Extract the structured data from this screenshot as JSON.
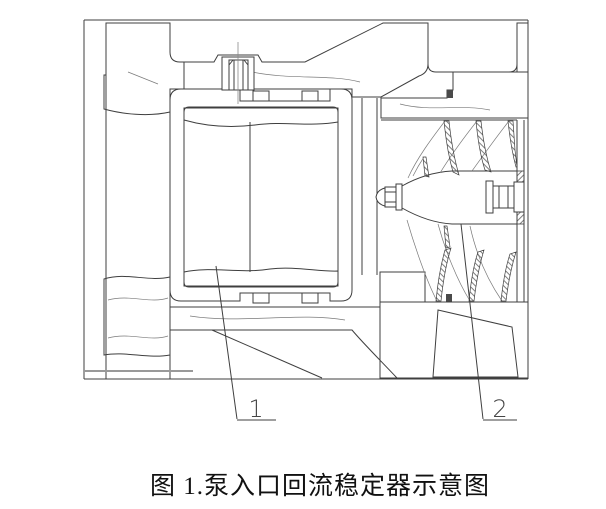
{
  "figure": {
    "caption": "图 1.泵入口回流稳定器示意图",
    "part_labels": [
      {
        "label": "1"
      },
      {
        "label": "2"
      }
    ],
    "colors": {
      "line": "#3f3f3f",
      "hatch": "#6f6f6f",
      "background": "#ffffff",
      "aux_gray": "#999999"
    }
  }
}
